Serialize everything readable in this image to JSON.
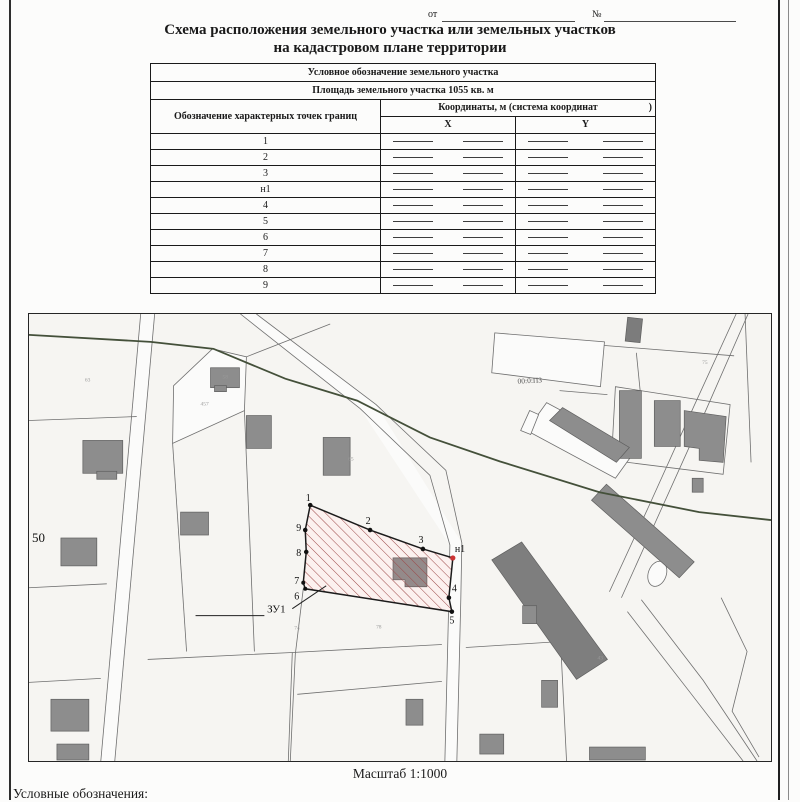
{
  "header": {
    "date_prefix": "от",
    "number_prefix": "№"
  },
  "title": {
    "line1": "Схема расположения земельного участка или земельных участков",
    "line2": "на кадастровом плане территории"
  },
  "table": {
    "designation_header": "Условное обозначение земельного участка",
    "area_header": "Площадь земельного участка 1055 кв. м",
    "points_col_header": "Обозначение характерных точек границ",
    "coords_header": "Координаты, м (система координат",
    "coords_header_close": ")",
    "x_label": "X",
    "y_label": "Y",
    "rows": [
      "1",
      "2",
      "3",
      "н1",
      "4",
      "5",
      "6",
      "7",
      "8",
      "9"
    ]
  },
  "map": {
    "region_label": "50",
    "quarter_label": "00:0:ПЗ",
    "parcel_label": "ЗУ1",
    "point_labels": [
      "1",
      "2",
      "3",
      "н1",
      "4",
      "5",
      "6",
      "7",
      "8",
      "9"
    ],
    "tiny_labels": [
      "63",
      "457",
      "58",
      "65",
      "74",
      "78",
      "75",
      "43"
    ],
    "colors": {
      "hatch": "#9c4848",
      "parcel_fill": "#fcf1ef",
      "point": "#111111",
      "new_point": "#cc3333",
      "boundary_line": "#44503a",
      "building": "#8d8d8d"
    }
  },
  "footer": {
    "scale": "Масштаб 1:1000",
    "legend_title": "Условные обозначения:"
  }
}
